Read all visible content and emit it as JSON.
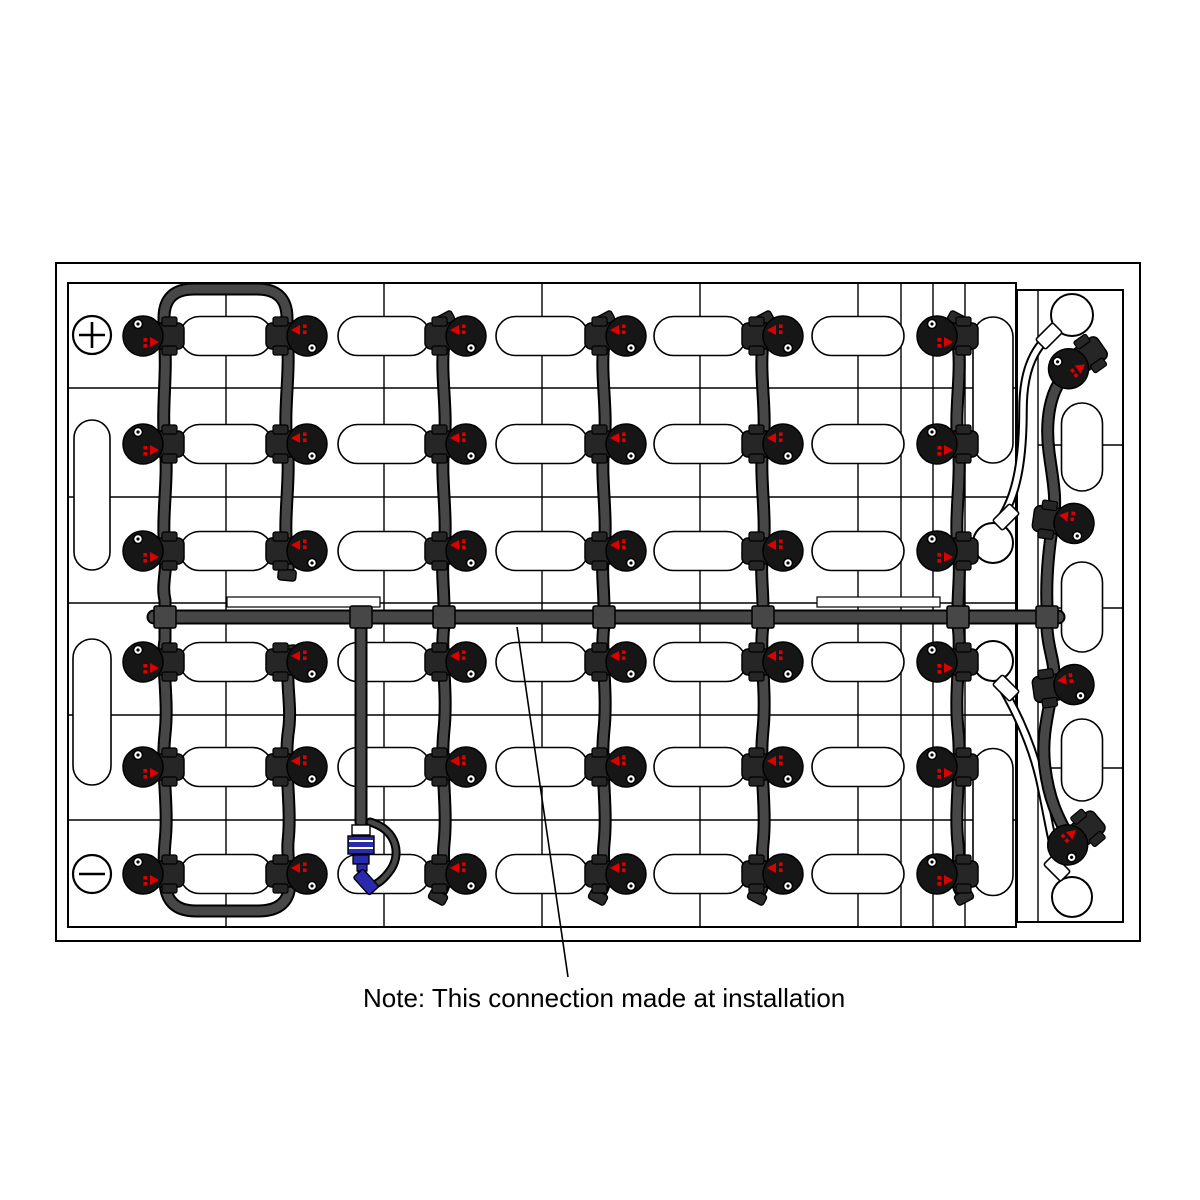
{
  "note": {
    "text": "Note: This connection made at installation"
  },
  "terminals": {
    "positive": {
      "symbol": "+",
      "x": 92,
      "y": 335,
      "r": 19
    },
    "negative": {
      "symbol": "−",
      "x": 92,
      "y": 874,
      "r": 19
    }
  },
  "colors": {
    "background": "#ffffff",
    "line": "#000000",
    "tube": "#474747",
    "tube_outline": "#000000",
    "valve_body": "#161616",
    "valve_cap": "#262626",
    "accent_red": "#dd0000",
    "connector_blue": "#2a2aae",
    "white": "#ffffff"
  },
  "structure": {
    "tray": {
      "x": 56,
      "y": 263,
      "w": 1084,
      "h": 678
    },
    "main_battery": {
      "x": 68,
      "y": 283,
      "w": 948,
      "h": 644
    },
    "right_battery": {
      "x": 1017,
      "y": 290,
      "w": 106,
      "h": 632
    },
    "v_lines": [
      [
        226,
        283,
        927
      ],
      [
        384,
        283,
        927
      ],
      [
        542,
        283,
        927
      ],
      [
        700,
        283,
        927
      ],
      [
        858,
        283,
        927
      ],
      [
        901,
        283,
        927
      ],
      [
        933,
        283,
        927
      ],
      [
        965,
        283,
        927
      ],
      [
        1038,
        290,
        922
      ]
    ],
    "h_lines": [
      [
        388,
        68,
        1016
      ],
      [
        497,
        68,
        1016
      ],
      [
        603,
        68,
        1016
      ],
      [
        715,
        68,
        1016
      ],
      [
        820,
        68,
        1016
      ],
      [
        445,
        1038,
        1123
      ],
      [
        608,
        1055,
        1123
      ],
      [
        768,
        1038,
        1123
      ]
    ],
    "strips": [
      [
        227,
        597,
        153,
        10
      ],
      [
        817,
        597,
        123,
        10
      ]
    ]
  },
  "pills": {
    "columns": [
      226,
      384,
      542,
      700,
      858
    ],
    "rows": [
      336,
      444,
      551,
      662,
      767,
      874
    ],
    "w": 92,
    "h": 39,
    "vertical": [
      [
        92,
        495,
        36,
        150
      ],
      [
        92,
        712,
        38,
        146
      ],
      [
        993,
        390,
        40,
        146
      ],
      [
        993,
        822,
        40,
        147
      ],
      [
        1082,
        447,
        41,
        88
      ],
      [
        1082,
        607,
        41,
        90
      ],
      [
        1082,
        760,
        41,
        82
      ]
    ]
  },
  "circles": [
    [
      1072,
      315,
      21
    ],
    [
      993,
      543,
      20
    ],
    [
      993,
      661,
      20
    ],
    [
      1072,
      897,
      20
    ]
  ],
  "tubes": {
    "manifold": "M 154,617 L 1058,617",
    "dark": [
      "M 165,622 L 165,600 C 161,584 168,568 165,551 C 161,515 169,480 165,444 C 161,408 168,372 164,336 L 164,318 Q 164,289 194,289 L 257,289 Q 287,289 287,318 L 287,336 C 291,372 283,408 287,444 C 291,480 283,515 287,551 C 289,560 288,566 288,572",
      "M 165,612 L 165,640 C 161,662 169,698 165,734 C 161,770 169,806 165,842 C 163,862 165,872 165,880 Q 165,911 196,911 L 258,911 Q 290,911 290,882 C 290,868 287,858 288,842 C 292,806 284,770 288,734 C 292,710 287,690 288,672 L 288,654",
      "M 447,320 C 440,328 444,334 444,342 C 440,376 448,410 444,444 C 440,478 448,514 444,551 C 441,570 444,588 444,608 L 444,626 C 440,650 448,690 444,730 C 440,768 448,806 444,844 C 442,862 446,874 444,884 C 443,890 440,893 437,896",
      "M 607,320 C 600,328 604,334 604,342 C 600,376 608,410 604,444 C 600,478 608,514 604,551 C 601,570 604,588 604,608 L 604,626 C 600,650 608,690 604,730 C 600,768 608,806 604,844 C 602,862 606,874 604,884 C 603,890 600,893 597,896",
      "M 766,320 C 759,328 763,334 763,342 C 759,376 767,410 763,444 C 759,478 767,514 763,551 C 760,570 763,588 763,608 L 763,626 C 759,650 767,690 763,730 C 759,768 767,806 763,844 C 761,862 765,874 763,884 C 762,890 759,893 756,896",
      "M 955,320 C 962,328 958,334 958,342 C 962,376 954,410 958,444 C 962,478 954,514 958,551 C 961,570 958,588 958,608 L 958,626 C 962,650 954,690 958,730 C 962,768 954,806 958,844 C 960,862 956,874 958,884 C 959,890 962,893 965,896",
      "M 1066,374 C 1050,390 1045,420 1049,452 C 1053,482 1057,498 1053,523 C 1048,553 1046,580 1047,606 L 1047,628 C 1048,652 1057,664 1053,687 C 1048,714 1041,738 1045,768 C 1049,800 1058,817 1067,834",
      "M 361,624 L 361,822"
    ],
    "white": [
      "M 1053,333 C 1031,349 1023,376 1023,410 C 1023,455 1018,492 1002,517",
      "M 1002,687 C 1017,713 1032,745 1040,780 C 1047,812 1052,844 1059,869"
    ],
    "tees": [
      [
        165,
        617
      ],
      [
        361,
        617
      ],
      [
        444,
        617
      ],
      [
        604,
        617
      ],
      [
        763,
        617
      ],
      [
        958,
        617
      ],
      [
        1047,
        617
      ]
    ],
    "end_caps": [
      [
        287,
        575,
        5
      ],
      [
        288,
        651,
        -5
      ],
      [
        445,
        319,
        -28
      ],
      [
        438,
        897,
        28
      ],
      [
        605,
        319,
        -28
      ],
      [
        598,
        897,
        28
      ],
      [
        764,
        319,
        -28
      ],
      [
        757,
        897,
        28
      ],
      [
        957,
        319,
        28
      ],
      [
        964,
        897,
        -28
      ]
    ],
    "fittings": [
      [
        1049,
        336,
        -45
      ],
      [
        1006,
        517,
        -45
      ],
      [
        1006,
        688,
        45
      ],
      [
        1057,
        868,
        45
      ]
    ]
  },
  "valves": {
    "grid": {
      "rows": [
        336,
        444,
        551,
        662,
        767,
        874
      ],
      "columns": [
        {
          "x": 146,
          "cap": "right",
          "variant": "dotTop"
        },
        {
          "x": 304,
          "cap": "left",
          "variant": "redTop"
        },
        {
          "x": 463,
          "cap": "left",
          "variant": "redTop"
        },
        {
          "x": 623,
          "cap": "left",
          "variant": "redTop"
        },
        {
          "x": 780,
          "cap": "left",
          "variant": "redTop"
        },
        {
          "x": 940,
          "cap": "right",
          "variant": "dotTop"
        }
      ]
    },
    "extra": [
      {
        "x": 1071,
        "y": 367,
        "cap": "right",
        "variant": "dotTop",
        "angle": -35
      },
      {
        "x": 1071,
        "y": 523,
        "cap": "left",
        "variant": "redTop",
        "angle": 8
      },
      {
        "x": 1071,
        "y": 685,
        "cap": "left",
        "variant": "redTop",
        "angle": -8
      },
      {
        "x": 1070,
        "y": 843,
        "cap": "left",
        "variant": "dotTop",
        "angle": 140
      }
    ]
  },
  "connector": {
    "band": [
      352,
      825,
      18,
      10
    ],
    "body": [
      348,
      836,
      26,
      18
    ],
    "stripes": [
      841,
      848
    ],
    "mid": [
      353,
      855,
      16,
      9
    ],
    "stem": [
      357,
      864,
      10,
      7
    ],
    "tip": [
      358,
      871,
      8,
      5
    ],
    "plug": {
      "cx": 366,
      "cy": 882,
      "w": 24,
      "h": 13,
      "angle": 48
    },
    "hang": "M 370,822 C 398,830 402,856 389,872 C 383,880 377,884 372,886"
  },
  "leader": {
    "x1": 517,
    "y1": 627,
    "x2": 568,
    "y2": 977
  }
}
